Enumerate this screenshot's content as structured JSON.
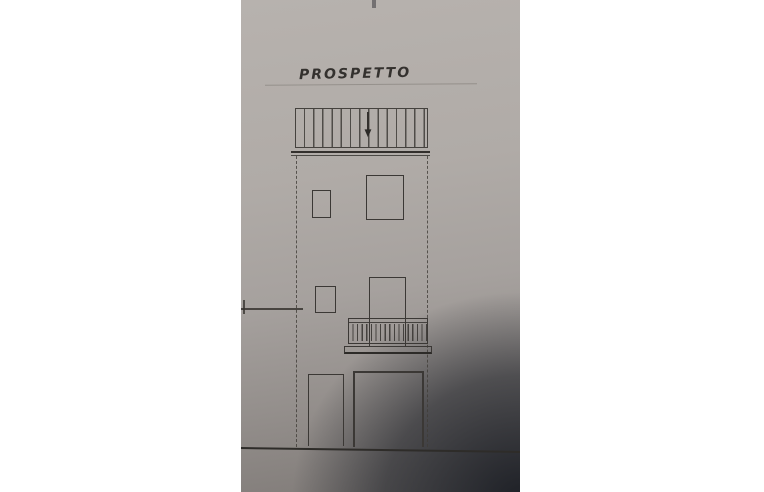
{
  "drawing": {
    "title": "PROSPETTO"
  },
  "icons": {
    "down_arrow": "▼"
  },
  "colors": {
    "margin_white": "#ffffff",
    "paper_light": "#b7b2ae",
    "paper_mid": "#a6a19e",
    "corner_shadow": "#35373c",
    "ink": "#3b3835"
  }
}
